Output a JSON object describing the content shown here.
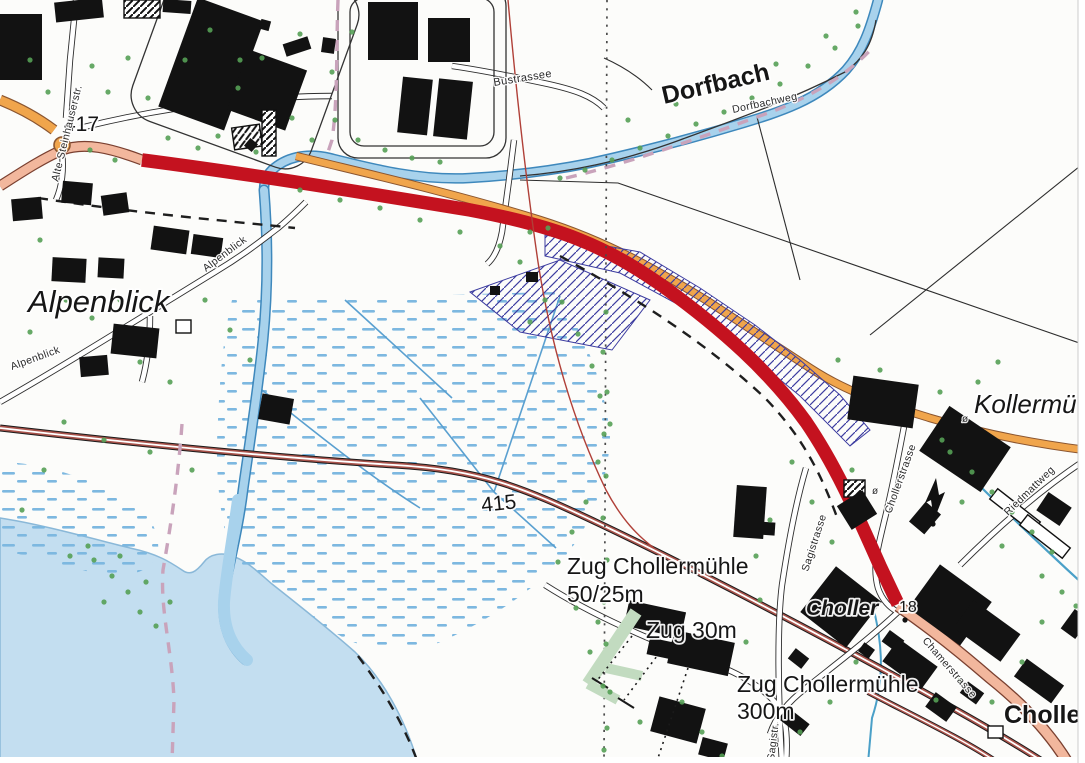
{
  "colors": {
    "route_highlight": "#c4121f",
    "main_road_fill": "#f2b79d",
    "secondary_road_fill": "#f0a54c",
    "water_fill": "#a8d2ec",
    "water_outline": "#3e88bc",
    "lake_fill": "#c3def0",
    "railway_line": "#a8524a",
    "construction_hatch": "#3c3ca0",
    "tree_green": "#55a055",
    "marsh_mark": "#7db8e0",
    "station_label": "#c41723",
    "water_label": "#1b6fb5",
    "boundary_line": "#b04038",
    "footpath_dashed": "#c9a3bb"
  },
  "map_labels": {
    "place_names": {
      "alpenblick": "Alpenblick",
      "kollermuehle": "Kollermü",
      "choller": "Choller"
    },
    "station": {
      "choller_station": "Cholle"
    },
    "water_names": {
      "dorfbach": "Dorfbach"
    },
    "street_names": {
      "alte_steinhauserstrasse": "Alte Steinhauserstr.",
      "bustrassee": "Bustrassee",
      "dorfbachweg": "Dorfbachweg",
      "alpenblick_street_upper": "Alpenblick",
      "alpenblick_street_lower": "Alpenblick",
      "sagistrasse": "Sagistrasse",
      "sagistrasse_short": "Sagistr.",
      "chollerstrasse": "Chollerstrasse",
      "chamerstrasse": "Chamerstrasse",
      "riedmattweg": "Riedmattweg"
    },
    "point_numbers": {
      "n417": "417",
      "n415": "415",
      "n18": "18"
    },
    "measurements": {
      "zug_chollermuehle_50_line1": "Zug Chollermühle",
      "zug_chollermuehle_50_line2": "50/25m",
      "zug_30": "Zug 30m",
      "zug_chollermuehle_300_line1": "Zug Chollermühle",
      "zug_chollermuehle_300_line2": "300m"
    },
    "symbols": {
      "diameter_1": "ø",
      "diameter_2": "ø"
    }
  }
}
